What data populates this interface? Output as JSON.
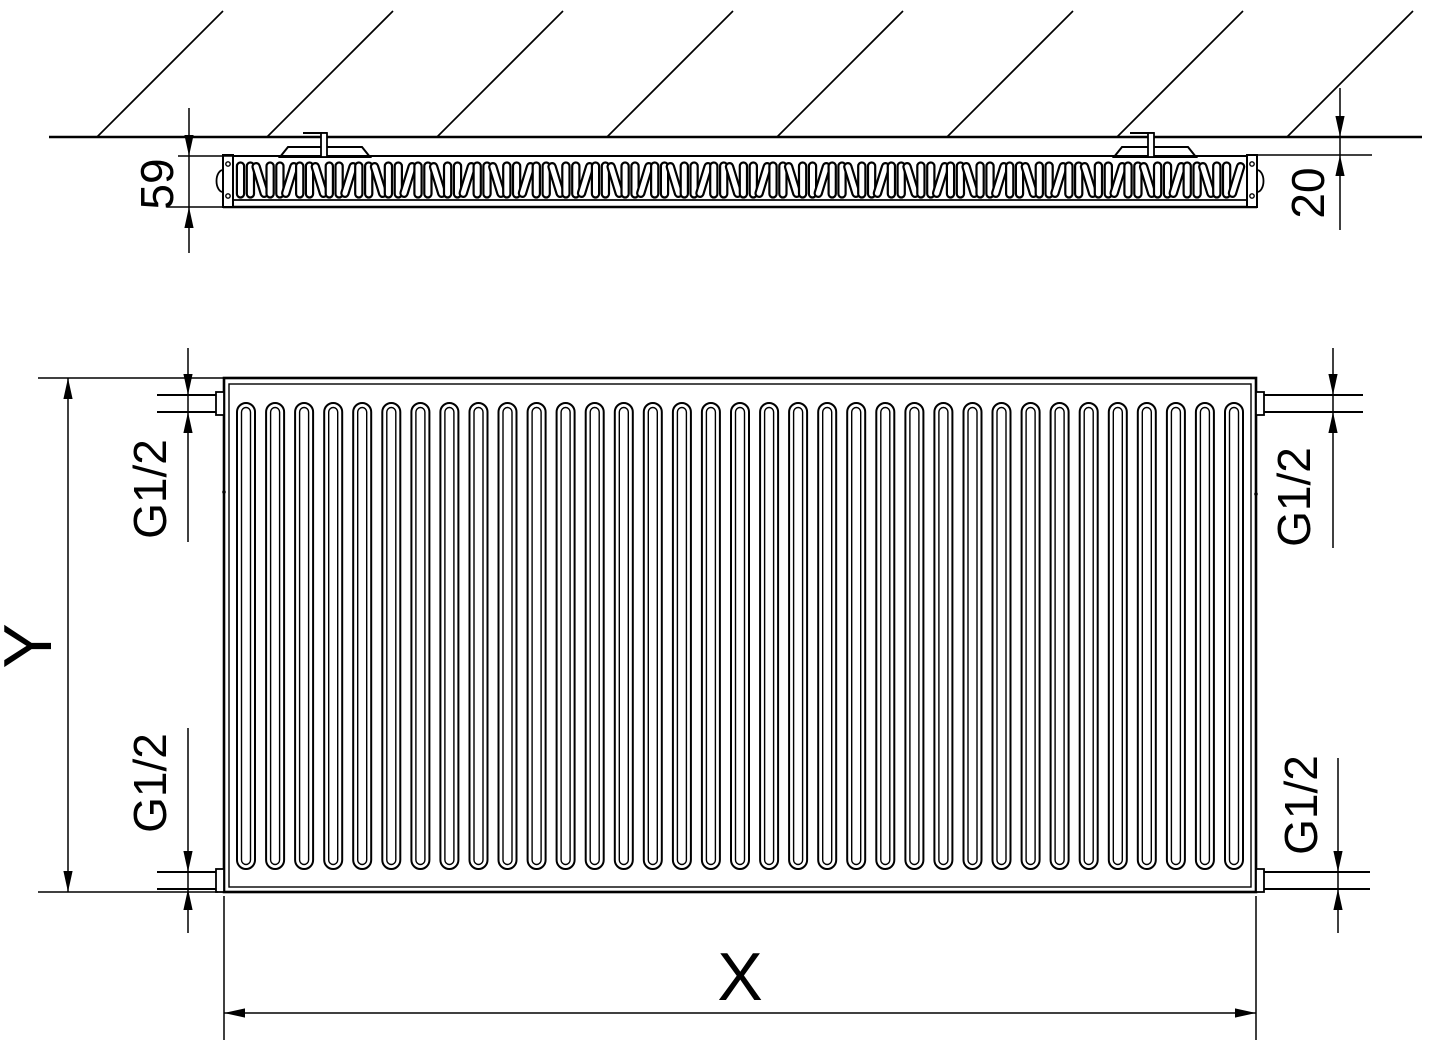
{
  "drawing_type": "radiator-technical-dimension-drawing",
  "labels": {
    "depth": "59",
    "wall_gap": "20",
    "height": "Y",
    "width": "X"
  },
  "connections": [
    {
      "position": "top-left",
      "label": "G1/2"
    },
    {
      "position": "top-right",
      "label": "G1/2"
    },
    {
      "position": "bottom-left",
      "label": "G1/2"
    },
    {
      "position": "bottom-right",
      "label": "G1/2"
    }
  ],
  "colors": {
    "line": "#000000",
    "background": "#ffffff"
  },
  "views": {
    "top_view": {
      "fin_loops": 102,
      "mounting_brackets": 2,
      "hatch_lines": 8
    },
    "front_view": {
      "corrugations": 35,
      "connection_stubs": 4
    }
  }
}
